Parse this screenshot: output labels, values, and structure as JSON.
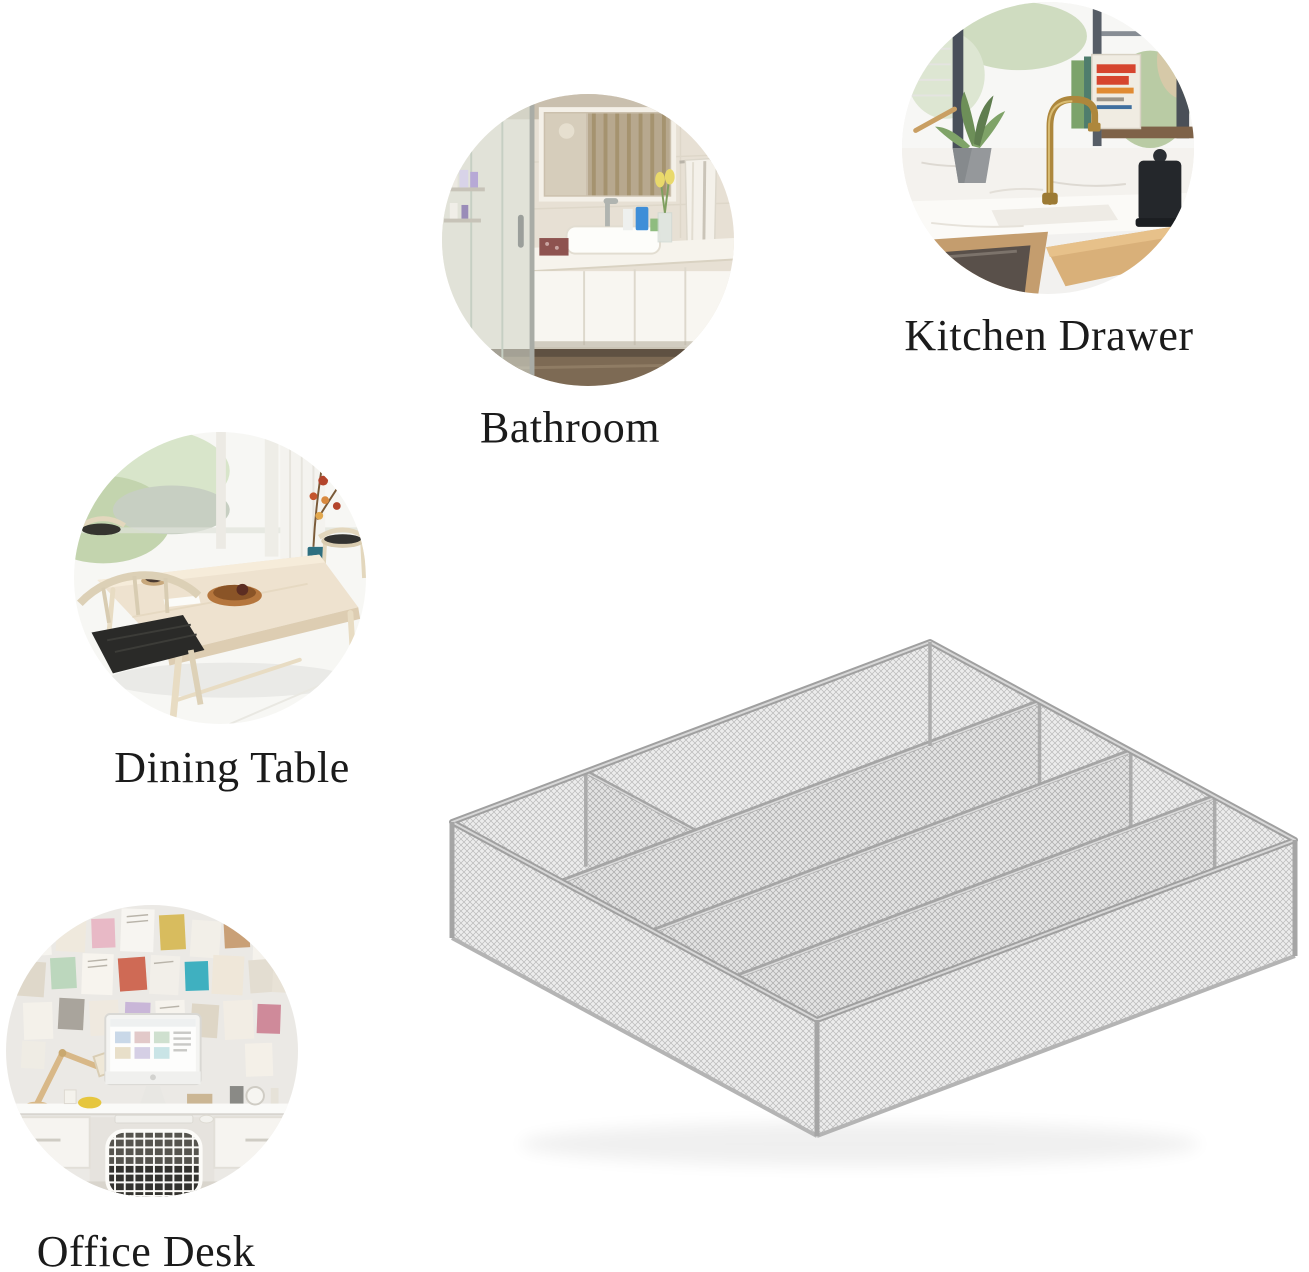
{
  "page": {
    "width": 1309,
    "height": 1272,
    "background": "#ffffff"
  },
  "scenes": [
    {
      "id": "kitchen-drawer",
      "label": "Kitchen Drawer"
    },
    {
      "id": "bathroom",
      "label": "Bathroom"
    },
    {
      "id": "dining-table",
      "label": "Dining Table"
    },
    {
      "id": "office-desk",
      "label": "Office Desk"
    }
  ],
  "product": {
    "name": "silver-mesh-cutlery-tray",
    "compartments": 5,
    "colors": {
      "mesh": "#efefef",
      "frame": "#a2a2a2",
      "accent_book_red": "#d6452e",
      "faucet_brass": "#ad873c"
    }
  }
}
